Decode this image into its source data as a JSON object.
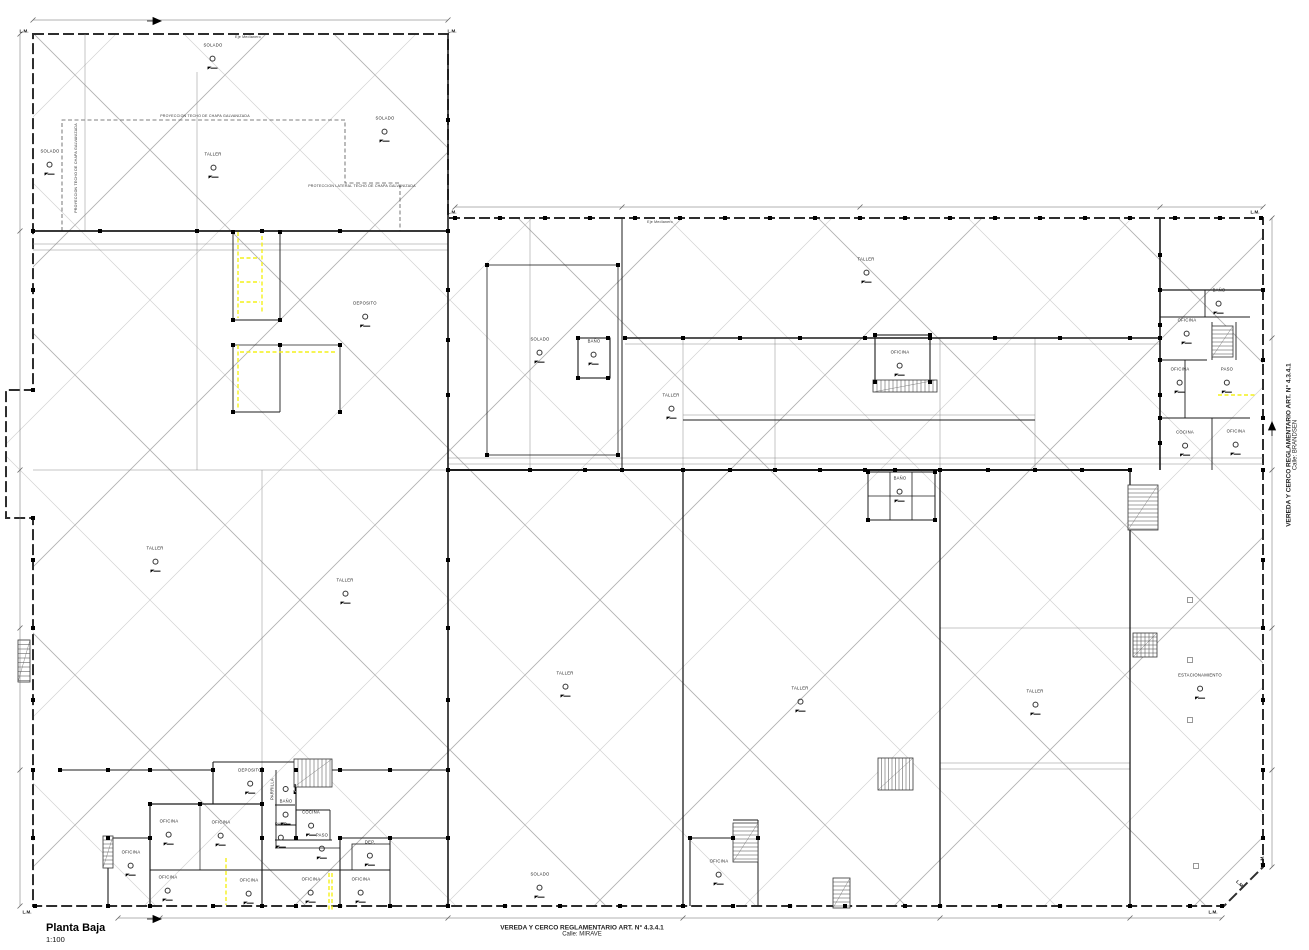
{
  "colors": {
    "bg": "#ffffff",
    "wall": "#1c1c1c",
    "thin": "#8a8a8a",
    "hatch": "#cdcdcd",
    "hatch2": "#b3b3b3",
    "yellow": "#f4f11c",
    "dim": "#666666"
  },
  "title_block": {
    "title": "Planta Baja",
    "scale": "1:100"
  },
  "notes": {
    "bottom_line1": "VEREDA Y CERCO REGLAMENTARIO  ART. N° 4.3.4.1",
    "bottom_line2": "Calle: MIRAVE",
    "right_line1": "VEREDA Y CERCO REGLAMENTARIO  ART. N° 4.3.4.1",
    "right_line2": "Calle: BRANDSEN"
  },
  "lm_text": "L.M.",
  "lm_markers": [
    {
      "x": 24,
      "y": 31
    },
    {
      "x": 452,
      "y": 31
    },
    {
      "x": 452,
      "y": 212
    },
    {
      "x": 1255,
      "y": 212
    },
    {
      "x": 27,
      "y": 912
    },
    {
      "x": 1213,
      "y": 912
    },
    {
      "x": 1262,
      "y": 860,
      "rot": -90
    },
    {
      "x": 1240,
      "y": 884,
      "rot": 45
    }
  ],
  "annotations": [
    {
      "text": "PROYECCION TECHO DE CHAPA GALVANIZADA",
      "x": 205,
      "y": 116
    },
    {
      "text": "PROTECCION LATERAL TECHO DE CHAPA GALVANIZADA",
      "x": 362,
      "y": 186
    },
    {
      "text": "PROYECCION TECHO DE CHAPA GALVANIZADA",
      "x": 76,
      "y": 168,
      "rot": -90
    },
    {
      "text": "Eje Medianero",
      "x": 248,
      "y": 37
    },
    {
      "text": "Eje Medianero",
      "x": 660,
      "y": 222
    }
  ],
  "rooms": [
    {
      "label": "SOLADO",
      "x": 213,
      "y": 57
    },
    {
      "label": "SOLADO",
      "x": 385,
      "y": 130
    },
    {
      "label": "SOLADO",
      "x": 50,
      "y": 163
    },
    {
      "label": "TALLER",
      "x": 213,
      "y": 166
    },
    {
      "label": "DEPOSITO",
      "x": 365,
      "y": 315
    },
    {
      "label": "SOLADO",
      "x": 540,
      "y": 351
    },
    {
      "label": "BAÑO",
      "x": 594,
      "y": 353
    },
    {
      "label": "TALLER",
      "x": 866,
      "y": 271
    },
    {
      "label": "TALLER",
      "x": 671,
      "y": 407
    },
    {
      "label": "OFICINA",
      "x": 900,
      "y": 364
    },
    {
      "label": "TALLER",
      "x": 155,
      "y": 560
    },
    {
      "label": "TALLER",
      "x": 345,
      "y": 592
    },
    {
      "label": "TALLER",
      "x": 565,
      "y": 685
    },
    {
      "label": "TALLER",
      "x": 800,
      "y": 700
    },
    {
      "label": "TALLER",
      "x": 1035,
      "y": 703
    },
    {
      "label": "ESTACIONAMIENTO",
      "x": 1200,
      "y": 687
    },
    {
      "label": "BAÑO",
      "x": 1219,
      "y": 302
    },
    {
      "label": "OFICINA",
      "x": 1187,
      "y": 332
    },
    {
      "label": "OFICINA",
      "x": 1180,
      "y": 381
    },
    {
      "label": "PASO",
      "x": 1227,
      "y": 381
    },
    {
      "label": "COCINA",
      "x": 1185,
      "y": 444
    },
    {
      "label": "OFICINA",
      "x": 1236,
      "y": 443
    },
    {
      "label": "BAÑO",
      "x": 900,
      "y": 490
    },
    {
      "label": "DEPOSITO",
      "x": 250,
      "y": 782
    },
    {
      "label": "OFICINA",
      "x": 169,
      "y": 833
    },
    {
      "label": "OFICINA",
      "x": 221,
      "y": 834
    },
    {
      "label": "OFICINA",
      "x": 131,
      "y": 864
    },
    {
      "label": "OFICINA",
      "x": 168,
      "y": 889
    },
    {
      "label": "OFICINA",
      "x": 249,
      "y": 892
    },
    {
      "label": "PARRILLA",
      "x": 284,
      "y": 789,
      "rot": -90
    },
    {
      "label": "BAÑO",
      "x": 286,
      "y": 813
    },
    {
      "label": "COCINA",
      "x": 311,
      "y": 824
    },
    {
      "label": "PASO",
      "x": 281,
      "y": 836
    },
    {
      "label": "PASO",
      "x": 322,
      "y": 847
    },
    {
      "label": "DEP.",
      "x": 370,
      "y": 854
    },
    {
      "label": "OFICINA",
      "x": 311,
      "y": 891
    },
    {
      "label": "OFICINA",
      "x": 361,
      "y": 891
    },
    {
      "label": "OFICINA",
      "x": 719,
      "y": 873
    },
    {
      "label": "SOLADO",
      "x": 540,
      "y": 886
    }
  ]
}
